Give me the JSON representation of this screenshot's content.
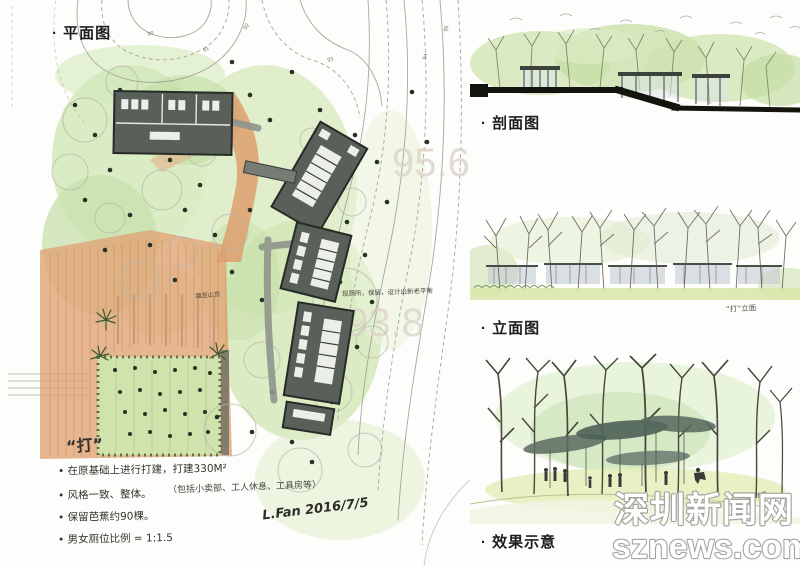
{
  "labels": {
    "plan": "· 平面图",
    "section": "· 剖面图",
    "elevation": "· 立面图",
    "effect": "· 效果示意"
  },
  "plan": {
    "elevation_marks": [
      "95.6",
      "93.8"
    ],
    "contour_labels": [
      "90",
      "91",
      "92",
      "93",
      "94",
      "95"
    ],
    "annotation": "现厕所，保留，设计出新老平衡",
    "path_note": "路至山顶"
  },
  "elevation_view": {
    "note": "“打”立面"
  },
  "effect_view": {
    "note": "“打”效果"
  },
  "notes": {
    "title": "“打”",
    "items": [
      "• 在原基础上进行打建，打建330M²",
      "（包括小卖部、工人休息、工具房等）",
      "• 风格一致、整体。",
      "• 保留芭蕉约90棵。",
      "• 男女厕位比例 = 1:1.5"
    ],
    "signature": "L.Fan  2016/7/5"
  },
  "watermark": {
    "line1": "深圳新闻网",
    "line2": "sznews.com"
  },
  "colors": {
    "foliage_green": "#cfe6b4",
    "path_orange": "#df9f6e",
    "building_gray": "#59605a",
    "ink": "#33332f",
    "watermark_outline": "#a3a3a0"
  }
}
